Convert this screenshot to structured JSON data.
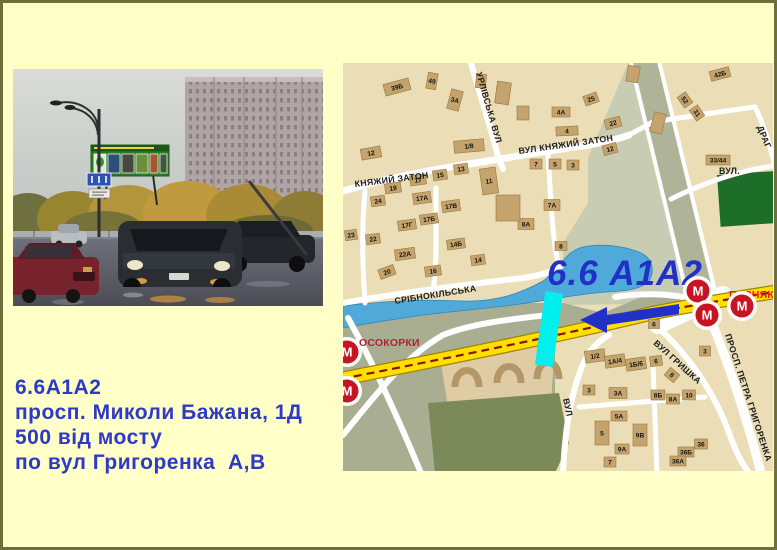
{
  "info_block": {
    "line1": "6.6А1А2",
    "line2": "просп. Миколи Бажана, 1Д",
    "line3": "500 від мосту",
    "line4": "по вул Григоренка  А,В"
  },
  "map": {
    "highlight_label": "6.6 А1А2",
    "metro_letter": "М",
    "red_labels": [
      {
        "text": "ОСОКОРКИ",
        "x": 356,
        "y": 343,
        "c": "#B52038"
      },
      {
        "text": "ПОЗНЯКИ",
        "x": 726,
        "y": 295,
        "c": "#E81828"
      }
    ],
    "street_labels": [
      {
        "text": "УРЛІВСЬКА  ВУЛ",
        "x": 473,
        "y": 70,
        "r": 74
      },
      {
        "text": "ВУЛ  КНЯЖИЙ  ЗАТОН",
        "x": 516,
        "y": 151,
        "r": -8
      },
      {
        "text": "КНЯЖИЙ ЗАТОН",
        "x": 352,
        "y": 184,
        "r": -7
      },
      {
        "text": "СРІБНОКІЛЬСЬКА",
        "x": 392,
        "y": 301,
        "r": -9
      },
      {
        "text": "ВУЛ.",
        "x": 716,
        "y": 171,
        "r": 0
      },
      {
        "text": "ДРАГ",
        "x": 754,
        "y": 124,
        "r": 68
      },
      {
        "text": "ВУЛ",
        "x": 560,
        "y": 396,
        "r": 78
      },
      {
        "text": "ВУЛ  ГРИШКА",
        "x": 650,
        "y": 341,
        "r": 42
      },
      {
        "text": "ПРОСП.  ПЕТРА  ГРИГОРЕНКА",
        "x": 722,
        "y": 332,
        "r": 72
      }
    ],
    "metro_stations": [
      {
        "x": 344,
        "y": 349
      },
      {
        "x": 344,
        "y": 388
      },
      {
        "x": 695,
        "y": 288
      },
      {
        "x": 704,
        "y": 312
      },
      {
        "x": 739,
        "y": 303
      }
    ],
    "buildings": [
      {
        "x": 394,
        "y": 84,
        "w": 26,
        "h": 12,
        "r": -15,
        "n": "39Б"
      },
      {
        "x": 429,
        "y": 78,
        "w": 10,
        "h": 16,
        "r": 10,
        "n": "49"
      },
      {
        "x": 452,
        "y": 97,
        "w": 12,
        "h": 20,
        "r": 15,
        "n": "3А"
      },
      {
        "x": 466,
        "y": 143,
        "w": 30,
        "h": 12,
        "r": -5,
        "n": "1/8"
      },
      {
        "x": 368,
        "y": 150,
        "w": 20,
        "h": 11,
        "r": -10,
        "n": "12"
      },
      {
        "x": 437,
        "y": 172,
        "w": 14,
        "h": 10,
        "r": -8,
        "n": "15"
      },
      {
        "x": 458,
        "y": 166,
        "w": 14,
        "h": 10,
        "r": -8,
        "n": "13"
      },
      {
        "x": 415,
        "y": 177,
        "w": 16,
        "h": 10,
        "r": -8,
        "n": "17"
      },
      {
        "x": 390,
        "y": 185,
        "w": 16,
        "h": 10,
        "r": -8,
        "n": "19"
      },
      {
        "x": 375,
        "y": 198,
        "w": 14,
        "h": 10,
        "r": -8,
        "n": "24"
      },
      {
        "x": 419,
        "y": 195,
        "w": 18,
        "h": 11,
        "r": -8,
        "n": "17А"
      },
      {
        "x": 448,
        "y": 203,
        "w": 18,
        "h": 11,
        "r": -8,
        "n": "17В"
      },
      {
        "x": 486,
        "y": 178,
        "w": 16,
        "h": 26,
        "r": -8,
        "n": "11"
      },
      {
        "x": 533,
        "y": 161,
        "w": 12,
        "h": 10,
        "r": 0,
        "n": "7"
      },
      {
        "x": 552,
        "y": 161,
        "w": 12,
        "h": 10,
        "r": 0,
        "n": "5"
      },
      {
        "x": 570,
        "y": 162,
        "w": 12,
        "h": 10,
        "r": 0,
        "n": "3"
      },
      {
        "x": 558,
        "y": 109,
        "w": 18,
        "h": 10,
        "r": 0,
        "n": "4А"
      },
      {
        "x": 564,
        "y": 128,
        "w": 22,
        "h": 9,
        "r": -3,
        "n": "4"
      },
      {
        "x": 588,
        "y": 96,
        "w": 14,
        "h": 10,
        "r": -20,
        "n": "25"
      },
      {
        "x": 610,
        "y": 120,
        "w": 16,
        "h": 10,
        "r": -15,
        "n": "22"
      },
      {
        "x": 607,
        "y": 146,
        "w": 14,
        "h": 10,
        "r": -15,
        "n": "12"
      },
      {
        "x": 717,
        "y": 71,
        "w": 20,
        "h": 10,
        "r": -15,
        "n": "42Б"
      },
      {
        "x": 694,
        "y": 110,
        "w": 13,
        "h": 10,
        "r": 55,
        "n": "31"
      },
      {
        "x": 682,
        "y": 97,
        "w": 13,
        "h": 10,
        "r": 55,
        "n": "52"
      },
      {
        "x": 715,
        "y": 157,
        "w": 24,
        "h": 10,
        "r": 0,
        "n": "33/44"
      },
      {
        "x": 426,
        "y": 216,
        "w": 18,
        "h": 10,
        "r": -8,
        "n": "17Б"
      },
      {
        "x": 404,
        "y": 222,
        "w": 18,
        "h": 10,
        "r": -8,
        "n": "17Г"
      },
      {
        "x": 370,
        "y": 236,
        "w": 14,
        "h": 10,
        "r": -8,
        "n": "22"
      },
      {
        "x": 348,
        "y": 232,
        "w": 12,
        "h": 10,
        "r": -8,
        "n": "23"
      },
      {
        "x": 402,
        "y": 251,
        "w": 20,
        "h": 11,
        "r": -8,
        "n": "22А"
      },
      {
        "x": 384,
        "y": 269,
        "w": 16,
        "h": 10,
        "r": -20,
        "n": "20"
      },
      {
        "x": 430,
        "y": 268,
        "w": 16,
        "h": 10,
        "r": -8,
        "n": "16"
      },
      {
        "x": 475,
        "y": 257,
        "w": 14,
        "h": 10,
        "r": -8,
        "n": "14"
      },
      {
        "x": 453,
        "y": 241,
        "w": 18,
        "h": 10,
        "r": -8,
        "n": "14Б"
      },
      {
        "x": 523,
        "y": 221,
        "w": 16,
        "h": 11,
        "r": 0,
        "n": "8А"
      },
      {
        "x": 549,
        "y": 202,
        "w": 16,
        "h": 11,
        "r": 0,
        "n": "7А"
      },
      {
        "x": 558,
        "y": 243,
        "w": 12,
        "h": 9,
        "r": 0,
        "n": "8"
      },
      {
        "x": 505,
        "y": 205,
        "w": 24,
        "h": 26,
        "r": 0,
        "n": ""
      },
      {
        "x": 630,
        "y": 71,
        "w": 12,
        "h": 16,
        "r": 10,
        "n": ""
      },
      {
        "x": 655,
        "y": 120,
        "w": 12,
        "h": 20,
        "r": 15,
        "n": ""
      },
      {
        "x": 500,
        "y": 90,
        "w": 14,
        "h": 22,
        "r": 8,
        "n": ""
      },
      {
        "x": 520,
        "y": 110,
        "w": 12,
        "h": 14,
        "r": 0,
        "n": ""
      },
      {
        "x": 478,
        "y": 78,
        "w": 10,
        "h": 14,
        "r": 5,
        "n": ""
      },
      {
        "x": 592,
        "y": 353,
        "w": 20,
        "h": 12,
        "r": -8,
        "n": "1/2"
      },
      {
        "x": 612,
        "y": 358,
        "w": 20,
        "h": 12,
        "r": -8,
        "n": "1А/4"
      },
      {
        "x": 633,
        "y": 361,
        "w": 20,
        "h": 12,
        "r": -8,
        "n": "1Б/6"
      },
      {
        "x": 653,
        "y": 358,
        "w": 12,
        "h": 10,
        "r": -8,
        "n": "6"
      },
      {
        "x": 669,
        "y": 372,
        "w": 12,
        "h": 10,
        "r": 40,
        "n": "8"
      },
      {
        "x": 586,
        "y": 387,
        "w": 12,
        "h": 10,
        "r": 0,
        "n": "3"
      },
      {
        "x": 615,
        "y": 390,
        "w": 18,
        "h": 11,
        "r": 0,
        "n": "3А"
      },
      {
        "x": 655,
        "y": 392,
        "w": 14,
        "h": 10,
        "r": 0,
        "n": "8Б"
      },
      {
        "x": 670,
        "y": 396,
        "w": 13,
        "h": 10,
        "r": 0,
        "n": "8А"
      },
      {
        "x": 686,
        "y": 392,
        "w": 13,
        "h": 10,
        "r": 0,
        "n": "10"
      },
      {
        "x": 616,
        "y": 413,
        "w": 16,
        "h": 10,
        "r": 0,
        "n": "5А"
      },
      {
        "x": 599,
        "y": 430,
        "w": 14,
        "h": 24,
        "r": 0,
        "n": "5"
      },
      {
        "x": 637,
        "y": 432,
        "w": 14,
        "h": 22,
        "r": 0,
        "n": "9В"
      },
      {
        "x": 619,
        "y": 446,
        "w": 14,
        "h": 10,
        "r": 0,
        "n": "9А"
      },
      {
        "x": 607,
        "y": 459,
        "w": 12,
        "h": 10,
        "r": 0,
        "n": "7"
      },
      {
        "x": 698,
        "y": 441,
        "w": 13,
        "h": 10,
        "r": 0,
        "n": "36"
      },
      {
        "x": 683,
        "y": 449,
        "w": 16,
        "h": 10,
        "r": 0,
        "n": "36Б"
      },
      {
        "x": 675,
        "y": 458,
        "w": 16,
        "h": 10,
        "r": 0,
        "n": "36А"
      },
      {
        "x": 702,
        "y": 348,
        "w": 11,
        "h": 10,
        "r": 0,
        "n": "3"
      },
      {
        "x": 651,
        "y": 321,
        "w": 11,
        "h": 9,
        "r": 0,
        "n": "6"
      }
    ]
  }
}
